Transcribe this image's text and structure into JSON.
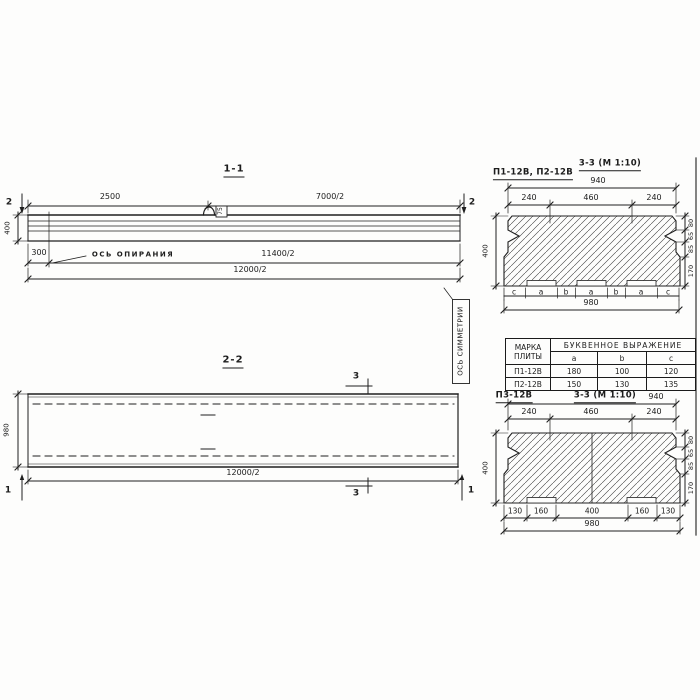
{
  "s11": {
    "title": "1-1",
    "dim_top_left": "2500",
    "dim_top_right": "7000/2",
    "cut_label": "2",
    "height": "400",
    "dim_overhang": "300",
    "bearing_label": "ОСЬ ОПИРАНИЯ",
    "dim_span": "11400/2",
    "dim_total": "12000/2",
    "loop_tag": "75"
  },
  "s22": {
    "title": "2-2",
    "cut3": "3",
    "cut1": "1",
    "width": "980",
    "dim_total": "12000/2",
    "symmetry_label": "ОСЬ СИММЕТРИИ"
  },
  "sec_top": {
    "marks": "П1-12В, П2-12В",
    "title": "3-3 (М 1:10)",
    "dim_940": "940",
    "dim_240": "240",
    "dim_460": "460",
    "height": "400",
    "right_dims": [
      "80",
      "65",
      "85",
      "170"
    ],
    "letters": [
      "c",
      "a",
      "b",
      "a",
      "b",
      "a",
      "c"
    ],
    "dim_980": "980"
  },
  "table": {
    "col1": "МАРКА ПЛИТЫ",
    "group": "БУКВЕННОЕ ВЫРАЖЕНИЕ",
    "cols": [
      "a",
      "b",
      "c"
    ],
    "rows": [
      {
        "mark": "П1-12В",
        "a": "180",
        "b": "100",
        "c": "120"
      },
      {
        "mark": "П2-12В",
        "a": "150",
        "b": "130",
        "c": "135"
      }
    ]
  },
  "sec_bot": {
    "mark": "П3-12В",
    "title": "3-3 (М 1:10)",
    "dim_940": "940",
    "dim_240": "240",
    "dim_460": "460",
    "height": "400",
    "right_dims": [
      "80",
      "65",
      "85",
      "170"
    ],
    "bottom_dims": [
      "130",
      "160",
      "400",
      "160",
      "130"
    ],
    "dim_980": "980"
  }
}
